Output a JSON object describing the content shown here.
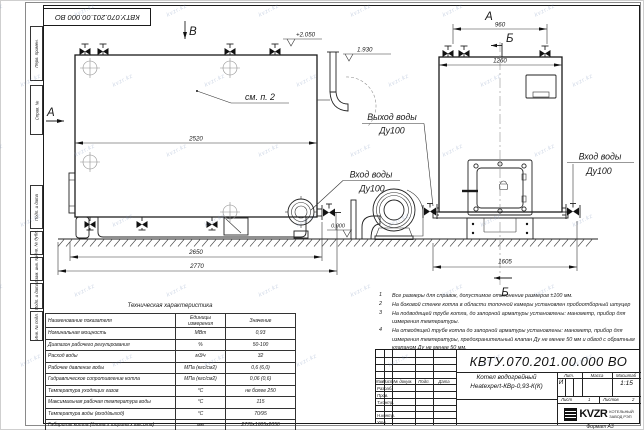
{
  "watermark": {
    "text": "kvzr.kz"
  },
  "corner_stamp": "КВТУ.070.201.00.000  ВО",
  "margin_stamps": [
    "Перв. примен.",
    "Справ. №",
    "Подп. и дата",
    "Инв. № дубл.",
    "Взам. инв. №",
    "Подп. и дата",
    "Инв. № подл."
  ],
  "drawing": {
    "view_labels": {
      "a_left": "А",
      "a_top": "А",
      "b_top": "В",
      "b_sec_top": "Б",
      "b_sec_bottom": "Б"
    },
    "callout_see_note": "см. п. 2",
    "dims": {
      "d2520": "2520",
      "d2650": "2650",
      "d2770": "2770",
      "d960": "960",
      "d1260": "1260",
      "d1605": "1605"
    },
    "elevations": {
      "top": "+2.050",
      "pipe": "1.930",
      "ground": "0.000"
    },
    "ports": {
      "outlet_line1": "Выход воды",
      "outlet_line2": "Ду100",
      "inlet_line1": "Вход воды",
      "inlet_line2": "Ду100"
    }
  },
  "tech_table": {
    "title": "Техническая характеристика",
    "headers": [
      "Наименование показателя",
      "Единицы измерения",
      "Значение"
    ],
    "rows": [
      [
        "Номинальная мощность",
        "МВт",
        "0,93"
      ],
      [
        "Диапазон рабочего регулирования",
        "%",
        "50-100"
      ],
      [
        "Расход воды",
        "м3/ч",
        "32"
      ],
      [
        "Рабочее давление воды",
        "МПа (кгс/см2)",
        "0,6 (6,0)"
      ],
      [
        "Гидравлическое сопротивление котла",
        "МПа (кгс/см2)",
        "0,06 (0,6)"
      ],
      [
        "Температура уходящих газов",
        "°С",
        "не более 250"
      ],
      [
        "Максимальная рабочая температура воды",
        "°С",
        "115"
      ],
      [
        "Температура воды (вход/выход)",
        "°С",
        "70/95"
      ],
      [
        "Габариты котла (длина х ширина х высота)",
        "мм",
        "2770х1605х2050"
      ]
    ]
  },
  "notes": [
    {
      "num": "1",
      "text": "Все размеры для справок, допустимое отклонение размеров ±100 мм."
    },
    {
      "num": "2",
      "text": "На боковой стенке котла в области топочной камеры установлен пробоотборный штуцер"
    },
    {
      "num": "3",
      "text": "На  подводящей трубе котла, до запорной арматуры установлены: манометр, прибор для измерения температуры."
    },
    {
      "num": "4",
      "text": "На отводящей трубе котла до запорной арматуры установлены: манометр, прибор для измерения температуры, предохранительный клапан Ду не менее 50 мм и обвод с обратным клапаном Ду не менее 50 мм."
    }
  ],
  "title_block": {
    "doc_number": "КВТУ.070.201.00.000  ВО",
    "product_name_1": "Котел водогрейный",
    "product_name_2": "Heatexpert-КВр-0,93-К(К)",
    "header_row": [
      "Изм.",
      "Лист",
      "№ докум.",
      "Подп.",
      "Дата"
    ],
    "sign_rows": [
      "Разраб.",
      "Пров.",
      "Т.контр.",
      "Н.контр.",
      "Утв."
    ],
    "lit_header": [
      "Лит.",
      "Масса",
      "Масштаб"
    ],
    "lit_value": "И",
    "scale": "1:15",
    "sheet_label": "Лист",
    "sheet_value": "1",
    "sheets_label": "Листов",
    "sheets_value": "2",
    "company": {
      "logo": "KVZR",
      "line1": "КОТЕЛЬНЫЙ",
      "line2": "ЗАВОД РЭП"
    },
    "format": "Формат  А3"
  }
}
